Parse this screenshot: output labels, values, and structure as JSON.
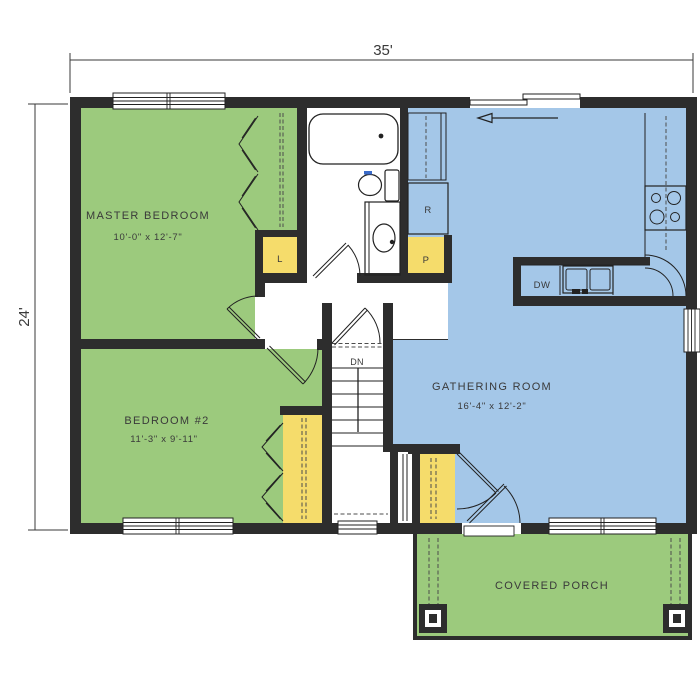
{
  "plan": {
    "title": "single-story house floor plan",
    "dimensions": {
      "overall_width": "35'",
      "overall_depth": "24'"
    },
    "rooms": [
      {
        "id": "master_bedroom",
        "name": "MASTER BEDROOM",
        "size": "10'-0\" x 12'-7\""
      },
      {
        "id": "bedroom_2",
        "name": "BEDROOM #2",
        "size": "11'-3\" x 9'-11\""
      },
      {
        "id": "gathering_room",
        "name": "GATHERING ROOM",
        "size": "16'-4\" x 12'-2\""
      },
      {
        "id": "covered_porch",
        "name": "COVERED PORCH",
        "size": ""
      }
    ],
    "labels": {
      "linen_closet": "L",
      "refrigerator": "R",
      "pantry": "P",
      "dishwasher": "DW",
      "stairs_down": "DN"
    },
    "colors": {
      "room_green": "#9CCA7D",
      "gathering_blue": "#A4C7E8",
      "closet_yellow": "#F5DC6B",
      "wall_dark": "#2D2D2D",
      "line_dark": "#222222",
      "text": "#3A3A3A"
    }
  }
}
